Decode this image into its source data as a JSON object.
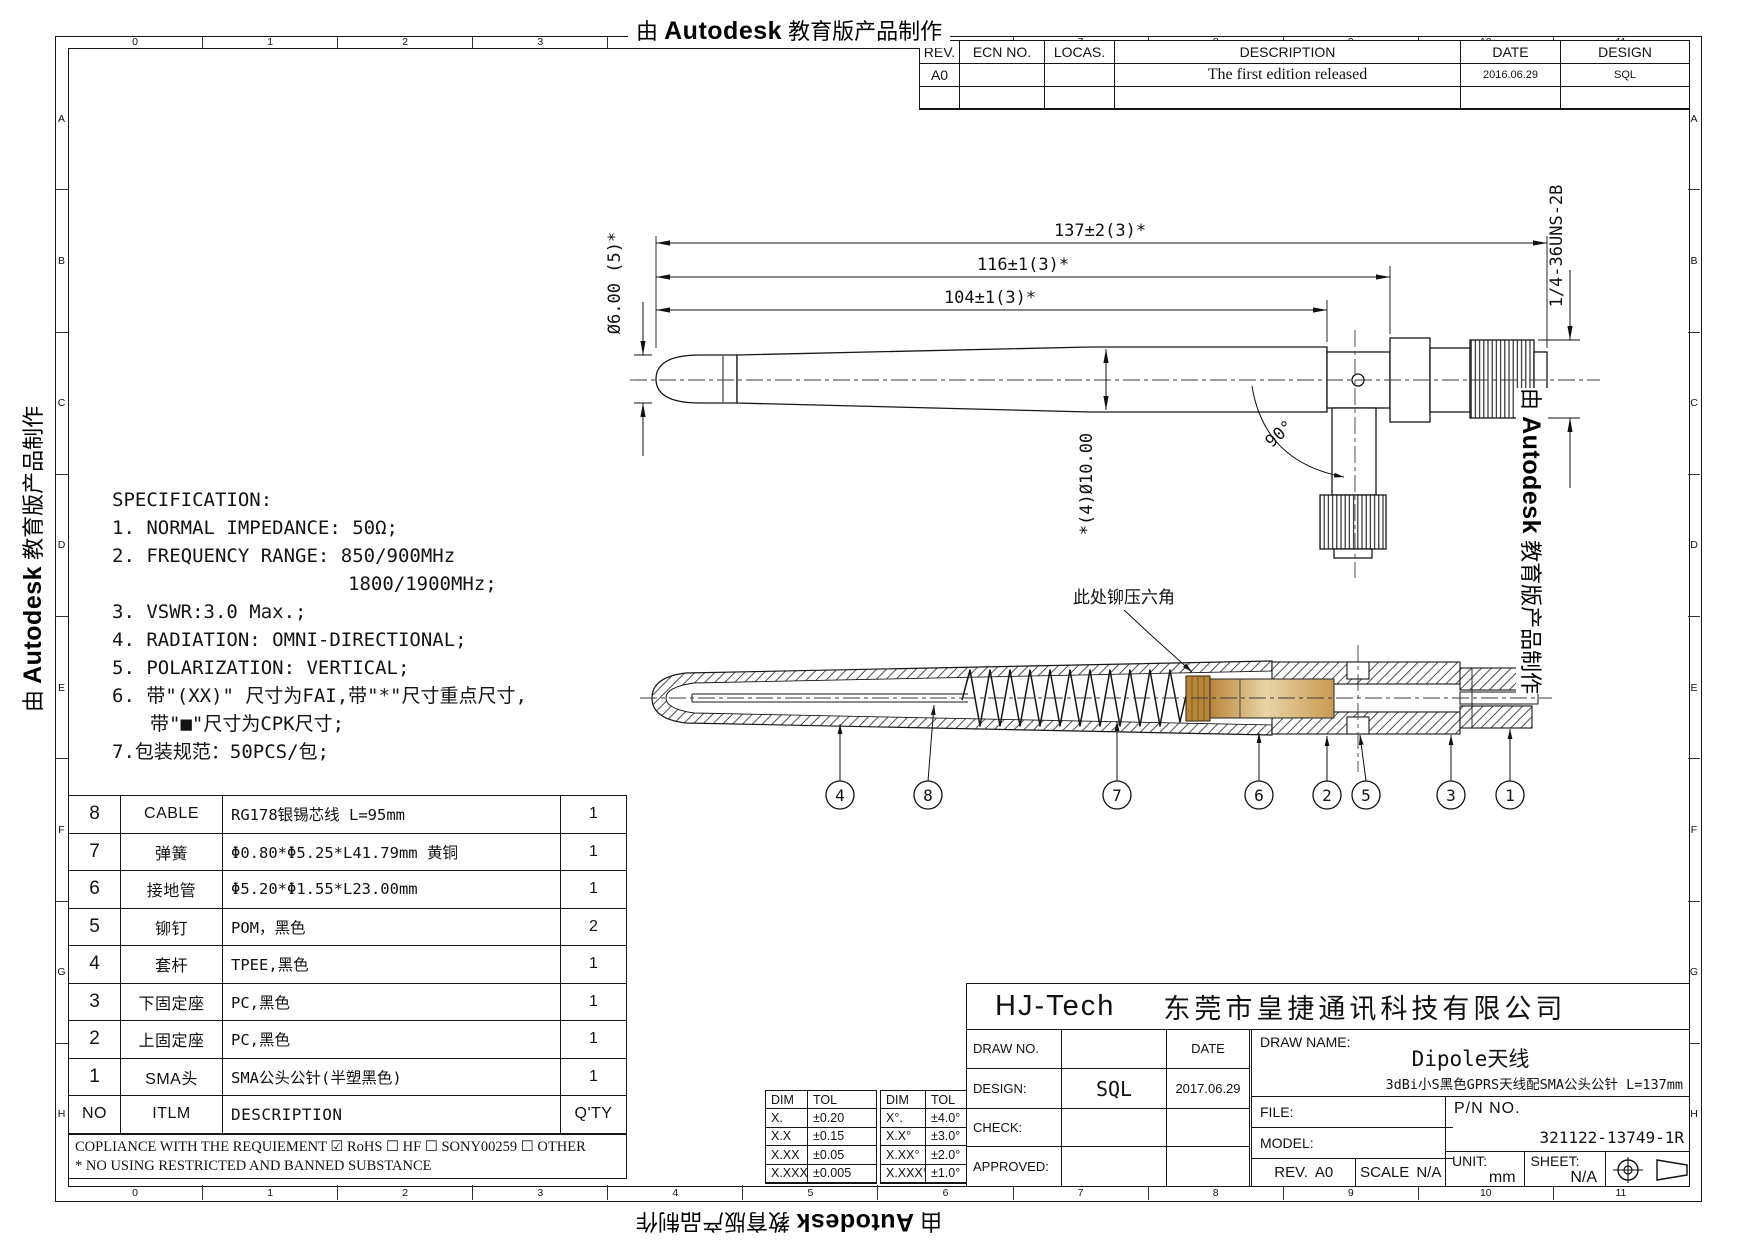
{
  "watermark": {
    "prefix": "由 ",
    "brand": "Autodesk",
    "suffix": " 教育版产品制作"
  },
  "grid": {
    "cols": [
      "0",
      "1",
      "2",
      "3",
      "4",
      "5",
      "6",
      "7",
      "8",
      "9",
      "10",
      "11"
    ],
    "rows": [
      "A",
      "B",
      "C",
      "D",
      "E",
      "F",
      "G",
      "H"
    ]
  },
  "revision_table": {
    "headers": {
      "rev": "REV.",
      "ecn": "ECN NO.",
      "locas": "LOCAS.",
      "description": "DESCRIPTION",
      "date": "DATE",
      "design": "DESIGN"
    },
    "row1": {
      "rev": "A0",
      "ecn": "",
      "locas": "",
      "description": "The first edition released",
      "date": "2016.06.29",
      "design": "SQL"
    }
  },
  "specification": {
    "title": "SPECIFICATION:",
    "line1": "1. NORMAL IMPEDANCE: 50Ω;",
    "line2": "2. FREQUENCY RANGE: 850/900MHz",
    "line2b": "1800/1900MHz;",
    "line3": "3. VSWR:3.0 Max.;",
    "line4": "4. RADIATION: OMNI-DIRECTIONAL;",
    "line5": "5. POLARIZATION: VERTICAL;",
    "line6": "6. 带\"(XX)\" 尺寸为FAI,带\"*\"尺寸重点尺寸,",
    "line6b": "带\"■\"尺寸为CPK尺寸;",
    "line7": "7.包装规范：50PCS/包;"
  },
  "drawing": {
    "dim_137": "137±2(3)*",
    "dim_116": "116±1(3)*",
    "dim_104": "104±1(3)*",
    "dim_d6": "Ø6.00 (5)*",
    "dim_d10": "*(4)Ø10.00",
    "dim_thread": "1/4-36UNS-2B",
    "dim_angle": "90°",
    "section_callout": "此处铆压六角",
    "balloons": [
      "4",
      "8",
      "7",
      "6",
      "2",
      "5",
      "3",
      "1"
    ]
  },
  "bom": {
    "headers": {
      "no": "NO",
      "itlm": "ITLM",
      "desc": "DESCRIPTION",
      "qty": "Q'TY"
    },
    "rows": [
      {
        "no": "8",
        "itlm": "CABLE",
        "desc": "RG178银锡芯线 L=95mm",
        "qty": "1"
      },
      {
        "no": "7",
        "itlm": "弹簧",
        "desc": "Φ0.80*Φ5.25*L41.79mm 黄铜",
        "qty": "1"
      },
      {
        "no": "6",
        "itlm": "接地管",
        "desc": "Φ5.20*Φ1.55*L23.00mm",
        "qty": "1"
      },
      {
        "no": "5",
        "itlm": "铆钉",
        "desc": "POM，黑色",
        "qty": "2"
      },
      {
        "no": "4",
        "itlm": "套杆",
        "desc": "TPEE,黑色",
        "qty": "1"
      },
      {
        "no": "3",
        "itlm": "下固定座",
        "desc": "PC,黑色",
        "qty": "1"
      },
      {
        "no": "2",
        "itlm": "上固定座",
        "desc": "PC,黑色",
        "qty": "1"
      },
      {
        "no": "1",
        "itlm": "SMA头",
        "desc": "SMA公头公针(半塑黑色)",
        "qty": "1"
      }
    ],
    "compliance": "COPLIANCE WITH THE REQUIEMENT ☑ RoHS ☐ HF ☐ SONY00259 ☐ OTHER",
    "note": "* NO USING RESTRICTED AND BANNED SUBSTANCE"
  },
  "tolerance": {
    "linear": {
      "dim": "DIM",
      "tol": "TOL",
      "rows": [
        [
          "X.",
          "±0.20"
        ],
        [
          "X.X",
          "±0.15"
        ],
        [
          "X.XX",
          "±0.05"
        ],
        [
          "X.XXX",
          "±0.005"
        ]
      ]
    },
    "angular": {
      "dim": "DIM",
      "tol": "TOL",
      "rows": [
        [
          "X°.",
          "±4.0°"
        ],
        [
          "X.X°",
          "±3.0°"
        ],
        [
          "X.XX°",
          "±2.0°"
        ],
        [
          "X.XXX°",
          "±1.0°"
        ]
      ]
    }
  },
  "title_block": {
    "company_short": "HJ-Tech",
    "company_full": "东莞市皇捷通讯科技有限公司",
    "draw_no_label": "DRAW NO.",
    "date_label": "DATE",
    "design_label": "DESIGN:",
    "design_value": "SQL",
    "design_date": "2017.06.29",
    "check_label": "CHECK:",
    "approved_label": "APPROVED:",
    "draw_name_label": "DRAW NAME:",
    "draw_name_value": "Dipole天线",
    "draw_name_sub": "3dBi小S黑色GPRS天线配SMA公头公针 L=137mm",
    "file_label": "FILE:",
    "model_label": "MODEL:",
    "rev_label": "REV.",
    "rev_value": "A0",
    "scale_label": "SCALE",
    "scale_value": "N/A",
    "pn_label": "P/N NO.",
    "pn_value": "321122-13749-1R",
    "unit_label": "UNIT:",
    "unit_value": "mm",
    "sheet_label": "SHEET:",
    "sheet_value": "N/A"
  }
}
